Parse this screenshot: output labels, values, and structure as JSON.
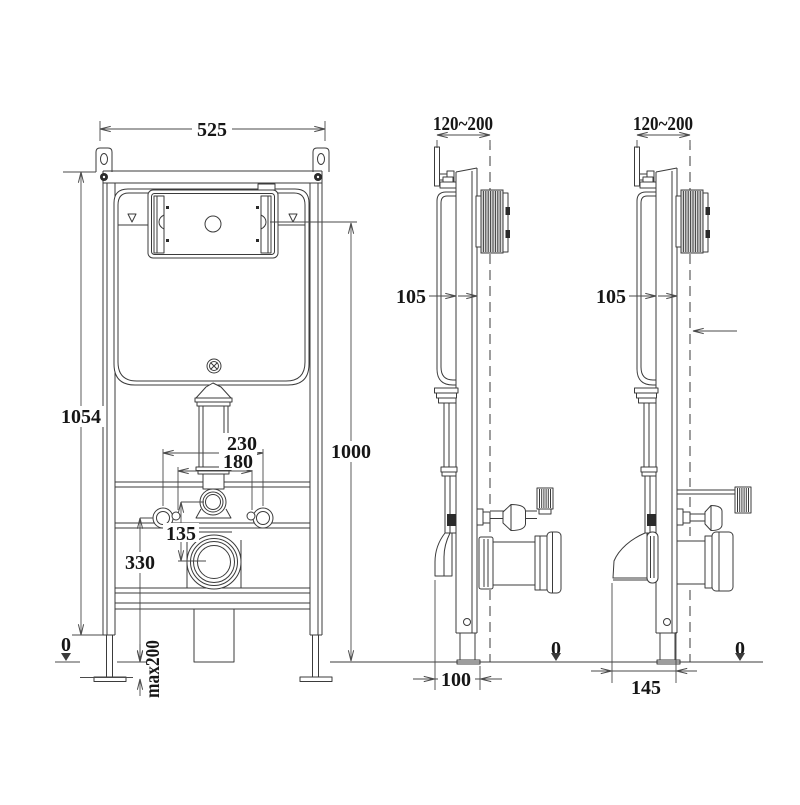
{
  "colors": {
    "line": "#3b3b3b",
    "background": "#ffffff",
    "hatch_fill": "#dedede"
  },
  "dims": {
    "front": {
      "width": "525",
      "frame_height": "1054",
      "install_height": "1000",
      "fixing_span_outer": "230",
      "fixing_span_inner": "180",
      "flush_to_waste": "135",
      "fixing_height": "330",
      "floor_datum": "0",
      "foot_adjust": "max200"
    },
    "side_left": {
      "depth_range": "120~200",
      "frame_depth": "105",
      "outlet_offset": "100",
      "floor_datum": "0"
    },
    "side_right": {
      "depth_range": "120~200",
      "frame_depth": "105",
      "outlet_offset": "145",
      "floor_datum": "0"
    }
  }
}
